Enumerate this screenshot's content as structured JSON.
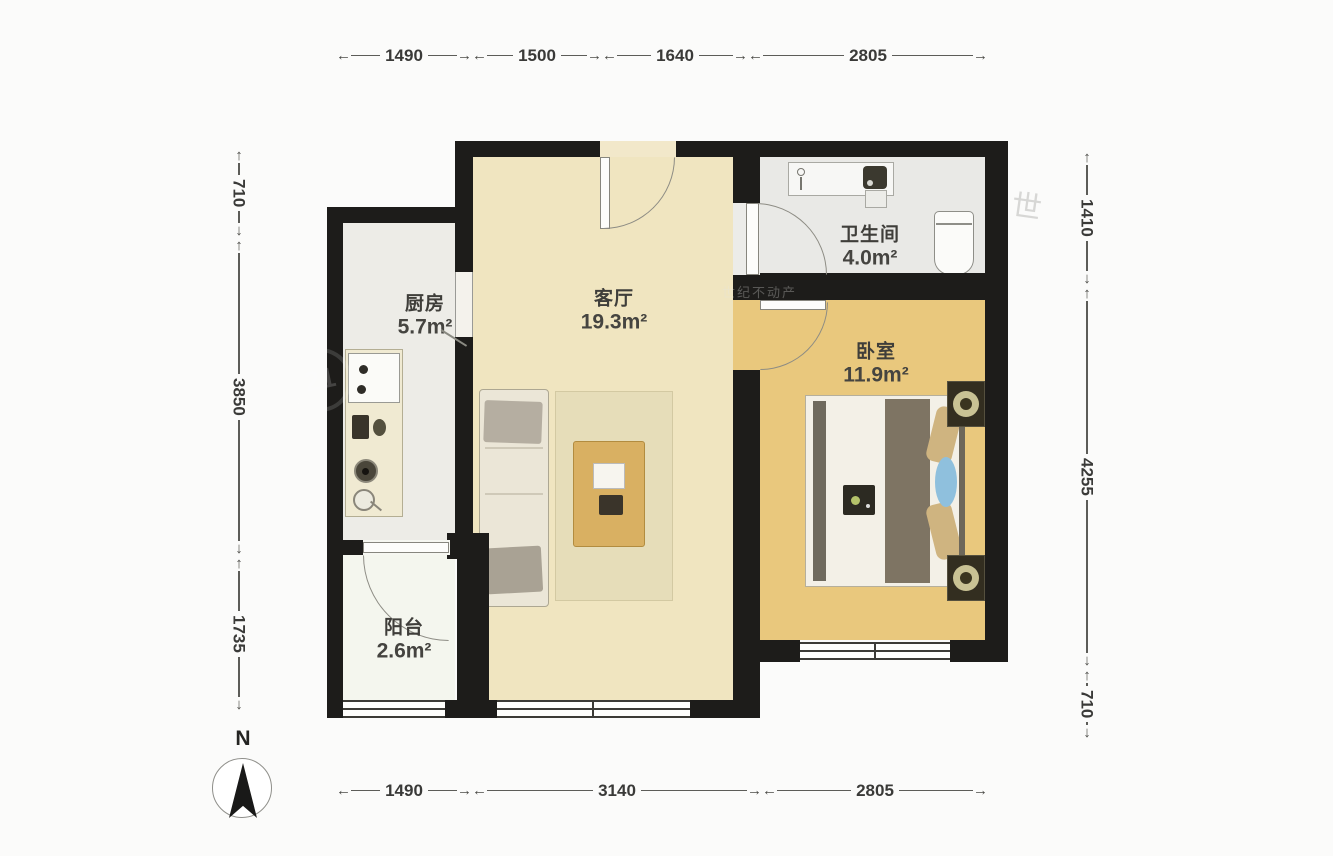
{
  "rooms": {
    "kitchen": {
      "name": "厨房",
      "area": "5.7m²"
    },
    "living": {
      "name": "客厅",
      "area": "19.3m²"
    },
    "bathroom": {
      "name": "卫生间",
      "area": "4.0m²"
    },
    "bedroom": {
      "name": "卧室",
      "area": "11.9m²"
    },
    "balcony": {
      "name": "阳台",
      "area": "2.6m²"
    }
  },
  "dims": {
    "top": [
      "1490",
      "1500",
      "1640",
      "2805"
    ],
    "bottom": [
      "1490",
      "3140",
      "2805"
    ],
    "left": [
      "710",
      "3850",
      "1735"
    ],
    "right": [
      "1410",
      "4255",
      "710"
    ]
  },
  "compass": {
    "north_label": "N"
  },
  "icons": {
    "arrow_left": "←",
    "arrow_right": "→",
    "arrow_up": "↑",
    "arrow_down": "↓"
  },
  "watermarks": {
    "logo": "21",
    "char": "世",
    "wall_text": "世纪不动产"
  },
  "colors": {
    "wall": "#1d1c1a",
    "living_floor": "#f0e5c0",
    "bedroom_floor": "#e9c87d",
    "kitchen_floor": "#edece7",
    "bathroom_floor": "#e9e9e6",
    "balcony_floor": "#f4f6ee",
    "coffee_table": "#d9b062",
    "bed_blanket": "#7e7463",
    "pillow": "#cfb480",
    "bed_cushion_blue": "#8fc0dd",
    "lamp": "#8b833f"
  }
}
